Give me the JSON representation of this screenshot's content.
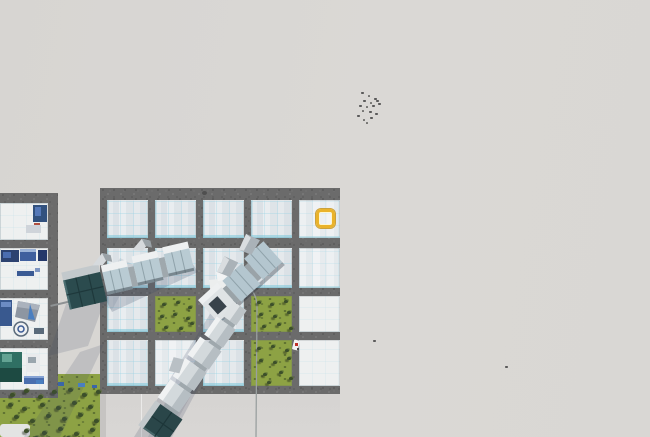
{
  "scene": {
    "kind": "city-builder-game-viewport",
    "view": "isometric top-down",
    "features": [
      "fog-of-war",
      "factory-tile-grid",
      "elevated-trains",
      "grass-with-trees",
      "tile-selection-highlight",
      "bird-flock"
    ]
  },
  "colors": {
    "fog": "#D9D7D4",
    "road": "#6B6B6B",
    "glass_tile": "#E3E8EB",
    "glass_line": "#A9D8E6",
    "white_tile": "#EEF0F0",
    "grass": "#8DA244",
    "tree": "#3C4F2A",
    "train_white": "#E9EBEC",
    "train_glass": "#B6C8D0",
    "train_teal_head": "#2B4B4E",
    "selection_yellow": "#EAB32A",
    "shadow": "#3D4A63",
    "machine_navy": "#2C4270",
    "machine_blue": "#3F5F9E",
    "machine_teal": "#2F6F63",
    "item_red": "#C03028",
    "pole_line": "#9AA0A0"
  },
  "selection": {
    "x": 316,
    "y": 209,
    "w": 19,
    "h": 19
  },
  "main_grid": {
    "x": 100,
    "y": 188,
    "w": 240,
    "h": 206,
    "col_x": [
      7,
      55,
      103,
      151,
      199
    ],
    "col_w": [
      41,
      41,
      41,
      41,
      41
    ],
    "row_y": [
      12,
      60,
      108,
      152
    ],
    "row_h": [
      38,
      40,
      36,
      46
    ],
    "cells": [
      [
        "glass",
        "glass",
        "glass",
        "glass",
        "glass-light"
      ],
      [
        "glass",
        "glass",
        "glass",
        "glass",
        "glass-light"
      ],
      [
        "glass",
        "grass",
        "glass",
        "grass",
        "white"
      ],
      [
        "glass",
        "glass-light",
        "glass",
        "grass",
        "white"
      ]
    ]
  },
  "left_grid": {
    "x": 0,
    "y": 193,
    "w": 58,
    "h": 205,
    "cell_w": 48,
    "row_y": [
      10,
      55,
      105,
      155
    ],
    "row_h": [
      37,
      42,
      42,
      42
    ],
    "cells": [
      "machines-blue-small",
      "machines-blue-dense",
      "machines-gray-tarp-circle",
      "machines-teal-robot"
    ]
  },
  "ground": {
    "apron": {
      "x": 100,
      "y": 394,
      "w": 240,
      "h": 43
    },
    "grass_field": [
      {
        "x": 0,
        "y": 386,
        "w": 103,
        "h": 51
      },
      {
        "x": 58,
        "y": 374,
        "w": 45,
        "h": 14
      }
    ]
  },
  "trains": [
    {
      "id": "train-glass-west",
      "style": "teal glass head + glazed cars",
      "heading": "east-northeast"
    },
    {
      "id": "train-hopper-center",
      "style": "white cars with gray hoppers",
      "heading": "northeast"
    },
    {
      "id": "train-diagonal-south",
      "style": "white cars, teal glass tail",
      "heading": "southwest"
    }
  ],
  "depot": {
    "x": 209,
    "y": 272,
    "w": 34,
    "h": 42
  },
  "red_item": {
    "x": 293,
    "y": 340
  },
  "pebble": {
    "x": 202,
    "y": 191
  },
  "trees": {
    "field": [
      [
        10,
        393
      ],
      [
        24,
        389
      ],
      [
        38,
        395
      ],
      [
        52,
        390
      ],
      [
        68,
        388
      ],
      [
        82,
        393
      ],
      [
        96,
        390
      ],
      [
        8,
        403
      ],
      [
        22,
        407
      ],
      [
        40,
        403
      ],
      [
        56,
        406
      ],
      [
        72,
        401
      ],
      [
        88,
        405
      ],
      [
        14,
        415
      ],
      [
        30,
        419
      ],
      [
        46,
        414
      ],
      [
        62,
        417
      ],
      [
        78,
        413
      ],
      [
        94,
        419
      ],
      [
        24,
        429
      ],
      [
        42,
        431
      ],
      [
        58,
        427
      ],
      [
        74,
        432
      ],
      [
        90,
        428
      ],
      [
        34,
        436
      ],
      [
        66,
        436
      ]
    ],
    "cells": [
      [
        162,
        303
      ],
      [
        176,
        301
      ],
      [
        188,
        306
      ],
      [
        160,
        315
      ],
      [
        173,
        313
      ],
      [
        186,
        317
      ],
      [
        164,
        326
      ],
      [
        179,
        327
      ],
      [
        190,
        322
      ],
      [
        257,
        301
      ],
      [
        270,
        303
      ],
      [
        284,
        300
      ],
      [
        259,
        313
      ],
      [
        273,
        315
      ],
      [
        287,
        311
      ],
      [
        262,
        325
      ],
      [
        277,
        323
      ],
      [
        289,
        327
      ],
      [
        257,
        347
      ],
      [
        271,
        345
      ],
      [
        285,
        349
      ],
      [
        259,
        359
      ],
      [
        273,
        361
      ],
      [
        287,
        357
      ],
      [
        263,
        373
      ],
      [
        279,
        371
      ],
      [
        289,
        377
      ],
      [
        267,
        381
      ]
    ]
  },
  "birds": {
    "flock": [
      [
        361,
        92
      ],
      [
        368,
        95
      ],
      [
        374,
        98
      ],
      [
        363,
        100
      ],
      [
        370,
        102
      ],
      [
        376,
        100
      ],
      [
        359,
        105
      ],
      [
        366,
        106
      ],
      [
        372,
        105
      ],
      [
        378,
        103
      ],
      [
        362,
        110
      ],
      [
        369,
        111
      ],
      [
        357,
        115
      ],
      [
        363,
        119
      ],
      [
        370,
        117
      ],
      [
        375,
        113
      ],
      [
        366,
        122
      ]
    ],
    "singles": [
      [
        373,
        340
      ],
      [
        505,
        366
      ]
    ]
  }
}
